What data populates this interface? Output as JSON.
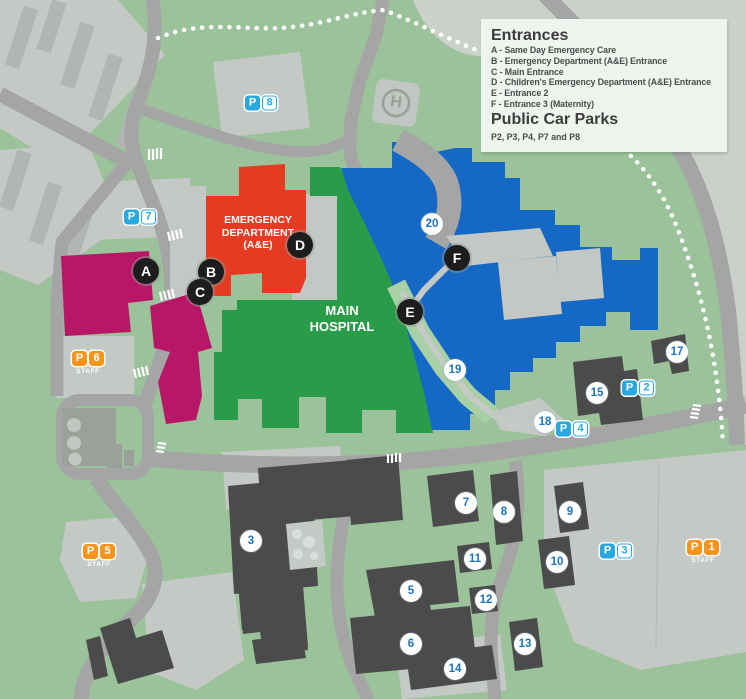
{
  "legend": {
    "title": "Entrances",
    "entries": [
      "A - Same Day Emergency Care",
      "B - Emergency Department (A&E) Entrance",
      "C - Main Entrance",
      "D - Children's Emergency Department (A&E) Entrance",
      "E - Entrance 2",
      "F - Entrance 3 (Maternity)"
    ],
    "car_parks_title": "Public Car Parks",
    "car_parks_note": "P2, P3, P4, P7 and P8"
  },
  "buildings": {
    "emergency_department": {
      "lines": [
        "EMERGENCY",
        "DEPARTMENT",
        "(A&E)"
      ]
    },
    "main_hospital": {
      "lines": [
        "MAIN",
        "HOSPITAL"
      ]
    }
  },
  "helipad": {
    "label": "H"
  },
  "staff_label": "STAFF",
  "markers": {
    "entrances": [
      {
        "label": "A",
        "x": 146,
        "y": 271
      },
      {
        "label": "B",
        "x": 211,
        "y": 272
      },
      {
        "label": "C",
        "x": 200,
        "y": 292
      },
      {
        "label": "D",
        "x": 300,
        "y": 245
      },
      {
        "label": "E",
        "x": 410,
        "y": 312
      },
      {
        "label": "F",
        "x": 457,
        "y": 258
      }
    ],
    "numbers": [
      {
        "label": "3",
        "x": 251,
        "y": 541
      },
      {
        "label": "5",
        "x": 411,
        "y": 591
      },
      {
        "label": "6",
        "x": 411,
        "y": 644
      },
      {
        "label": "7",
        "x": 466,
        "y": 503
      },
      {
        "label": "8",
        "x": 504,
        "y": 512
      },
      {
        "label": "9",
        "x": 570,
        "y": 512
      },
      {
        "label": "10",
        "x": 557,
        "y": 562
      },
      {
        "label": "11",
        "x": 475,
        "y": 559
      },
      {
        "label": "12",
        "x": 486,
        "y": 600
      },
      {
        "label": "13",
        "x": 525,
        "y": 644
      },
      {
        "label": "14",
        "x": 455,
        "y": 669
      },
      {
        "label": "15",
        "x": 597,
        "y": 393
      },
      {
        "label": "17",
        "x": 677,
        "y": 352
      },
      {
        "label": "18",
        "x": 545,
        "y": 422
      },
      {
        "label": "19",
        "x": 455,
        "y": 370
      },
      {
        "label": "20",
        "x": 432,
        "y": 224
      }
    ]
  },
  "car_parks": [
    {
      "letter": "P",
      "number": "1",
      "x": 703,
      "y": 552,
      "staff": true
    },
    {
      "letter": "P",
      "number": "2",
      "x": 638,
      "y": 388,
      "staff": false
    },
    {
      "letter": "P",
      "number": "3",
      "x": 616,
      "y": 551,
      "staff": false
    },
    {
      "letter": "P",
      "number": "4",
      "x": 572,
      "y": 429,
      "staff": false
    },
    {
      "letter": "P",
      "number": "5",
      "x": 99,
      "y": 556,
      "staff": true
    },
    {
      "letter": "P",
      "number": "6",
      "x": 88,
      "y": 363,
      "staff": true
    },
    {
      "letter": "P",
      "number": "7",
      "x": 140,
      "y": 217,
      "staff": false
    },
    {
      "letter": "P",
      "number": "8",
      "x": 261,
      "y": 103,
      "staff": false
    }
  ],
  "colors": {
    "background_green": "#9bc29b",
    "hospital_green": "#2a9b48",
    "emergency_red": "#e63b23",
    "ward_blue": "#1569c4",
    "maternity_magenta": "#b81768",
    "public_parking_blue": "#29a8e0",
    "staff_parking_orange": "#f7941d",
    "number_blue": "#1b74bc",
    "entrance_black": "#1d1d1d"
  }
}
